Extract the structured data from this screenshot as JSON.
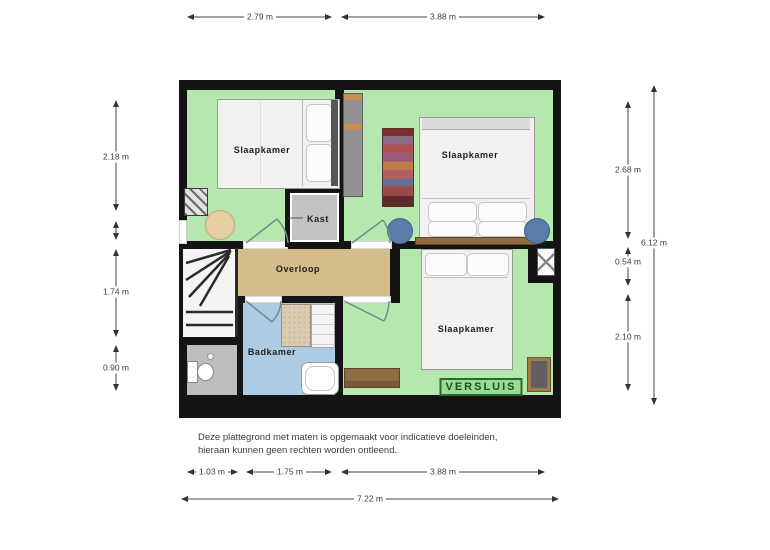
{
  "floorplan": {
    "rooms": {
      "bedroom_top_left": {
        "label": "Slaapkamer"
      },
      "bedroom_top_right": {
        "label": "Slaapkamer"
      },
      "bedroom_bottom": {
        "label": "Slaapkamer"
      },
      "closet": {
        "label": "Kast"
      },
      "landing": {
        "label": "Overloop"
      },
      "bathroom": {
        "label": "Badkamer"
      }
    },
    "watermark": "VERSLUIS"
  },
  "dimensions": {
    "top": {
      "left": "2.79 m",
      "right": "3.88 m"
    },
    "left_side": {
      "top": "2.18 m",
      "middle": "1.74 m",
      "bottom": "0.90 m"
    },
    "right_inner": {
      "top": "2.68 m",
      "middle": "0.54 m",
      "bottom": "2.10 m"
    },
    "right_total": "6.12 m",
    "bottom": {
      "seg1": "1.03 m",
      "seg2": "1.75 m",
      "seg3": "3.88 m",
      "total": "7.22 m"
    }
  },
  "disclaimer": {
    "line1": "Deze plattegrond met maten is opgemaakt voor indicatieve doeleinden,",
    "line2": "hieraan kunnen geen rechten worden ontleend."
  },
  "colors": {
    "wall": "#141414",
    "floor_green": "#b5e7ae",
    "landing_tan": "#d4bd8b",
    "bathroom_blue": "#adcbe3",
    "closet_gray": "#c2c2c2",
    "watermark_green": "#2a6b2a"
  }
}
